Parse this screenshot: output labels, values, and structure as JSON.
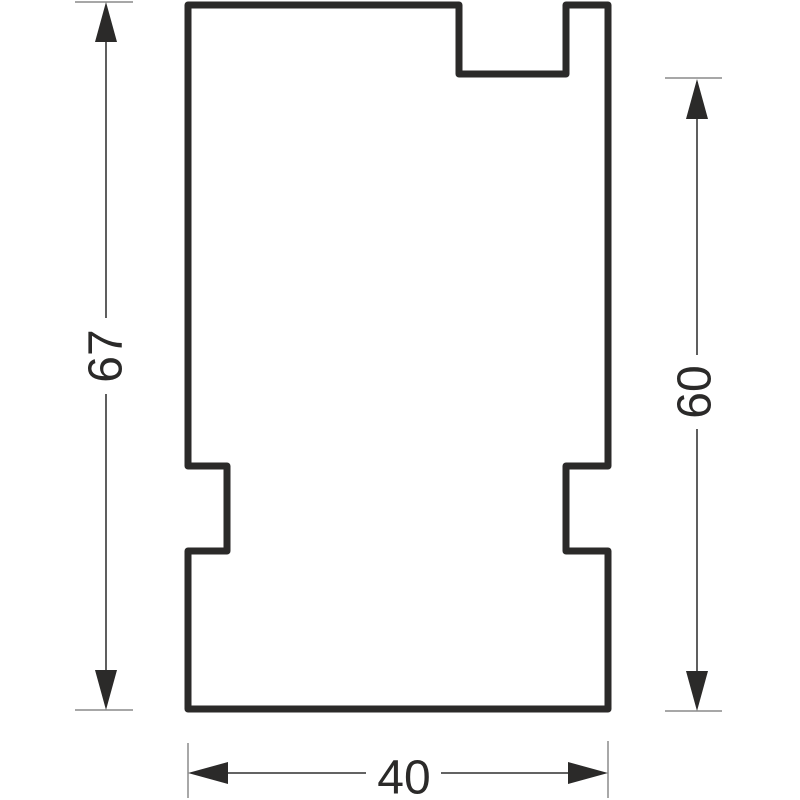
{
  "page": {
    "background": "#ffffff",
    "kind": "technical dimension drawing"
  },
  "colors": {
    "outline": "#2b2a29",
    "dimension_line": "#4d4d4d",
    "extension_line": "#8a8a8a",
    "arrow": "#2b2a29",
    "text": "#2b2a29"
  },
  "profile": {
    "path_d": "M 188 5 L 459 5 L 459 74 L 566 74 L 566 5 L 608 5 L 608 466 L 566 466 L 566 551 L 608 551 L 608 709 L 188 709 L 188 551 L 227 551 L 227 466 L 188 466 Z"
  },
  "dimensions": {
    "left": {
      "value": "67",
      "orientation": "vertical"
    },
    "right": {
      "value": "60",
      "orientation": "vertical"
    },
    "bottom": {
      "value": "40",
      "orientation": "horizontal"
    }
  }
}
